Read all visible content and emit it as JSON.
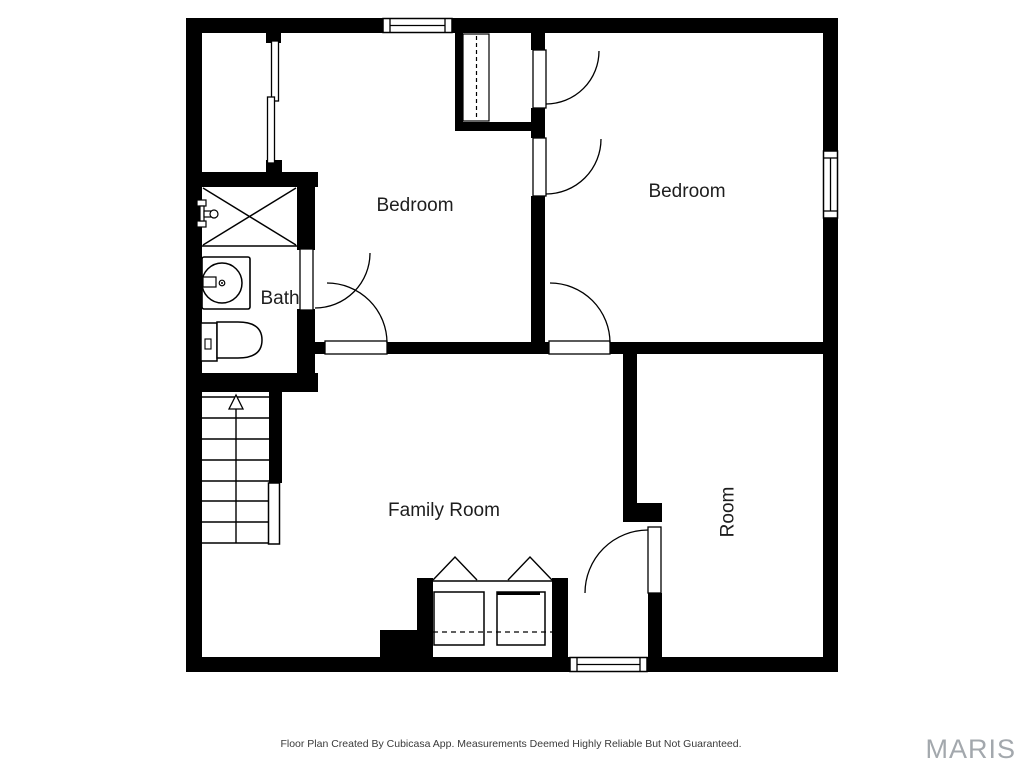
{
  "rooms": {
    "bedroom_left": "Bedroom",
    "bedroom_right": "Bedroom",
    "bath": "Bath",
    "family_room": "Family Room",
    "room": "Room"
  },
  "footer": {
    "disclaimer": "Floor Plan Created By Cubicasa App. Measurements Deemed Highly Reliable But Not Guaranteed."
  },
  "watermark": {
    "label": "MARIS"
  },
  "colors": {
    "wall": "#000000",
    "room_label": "#1e1e1e",
    "footer_text": "#3a3a3a",
    "watermark": "#a3a8ad",
    "background": "#ffffff"
  }
}
